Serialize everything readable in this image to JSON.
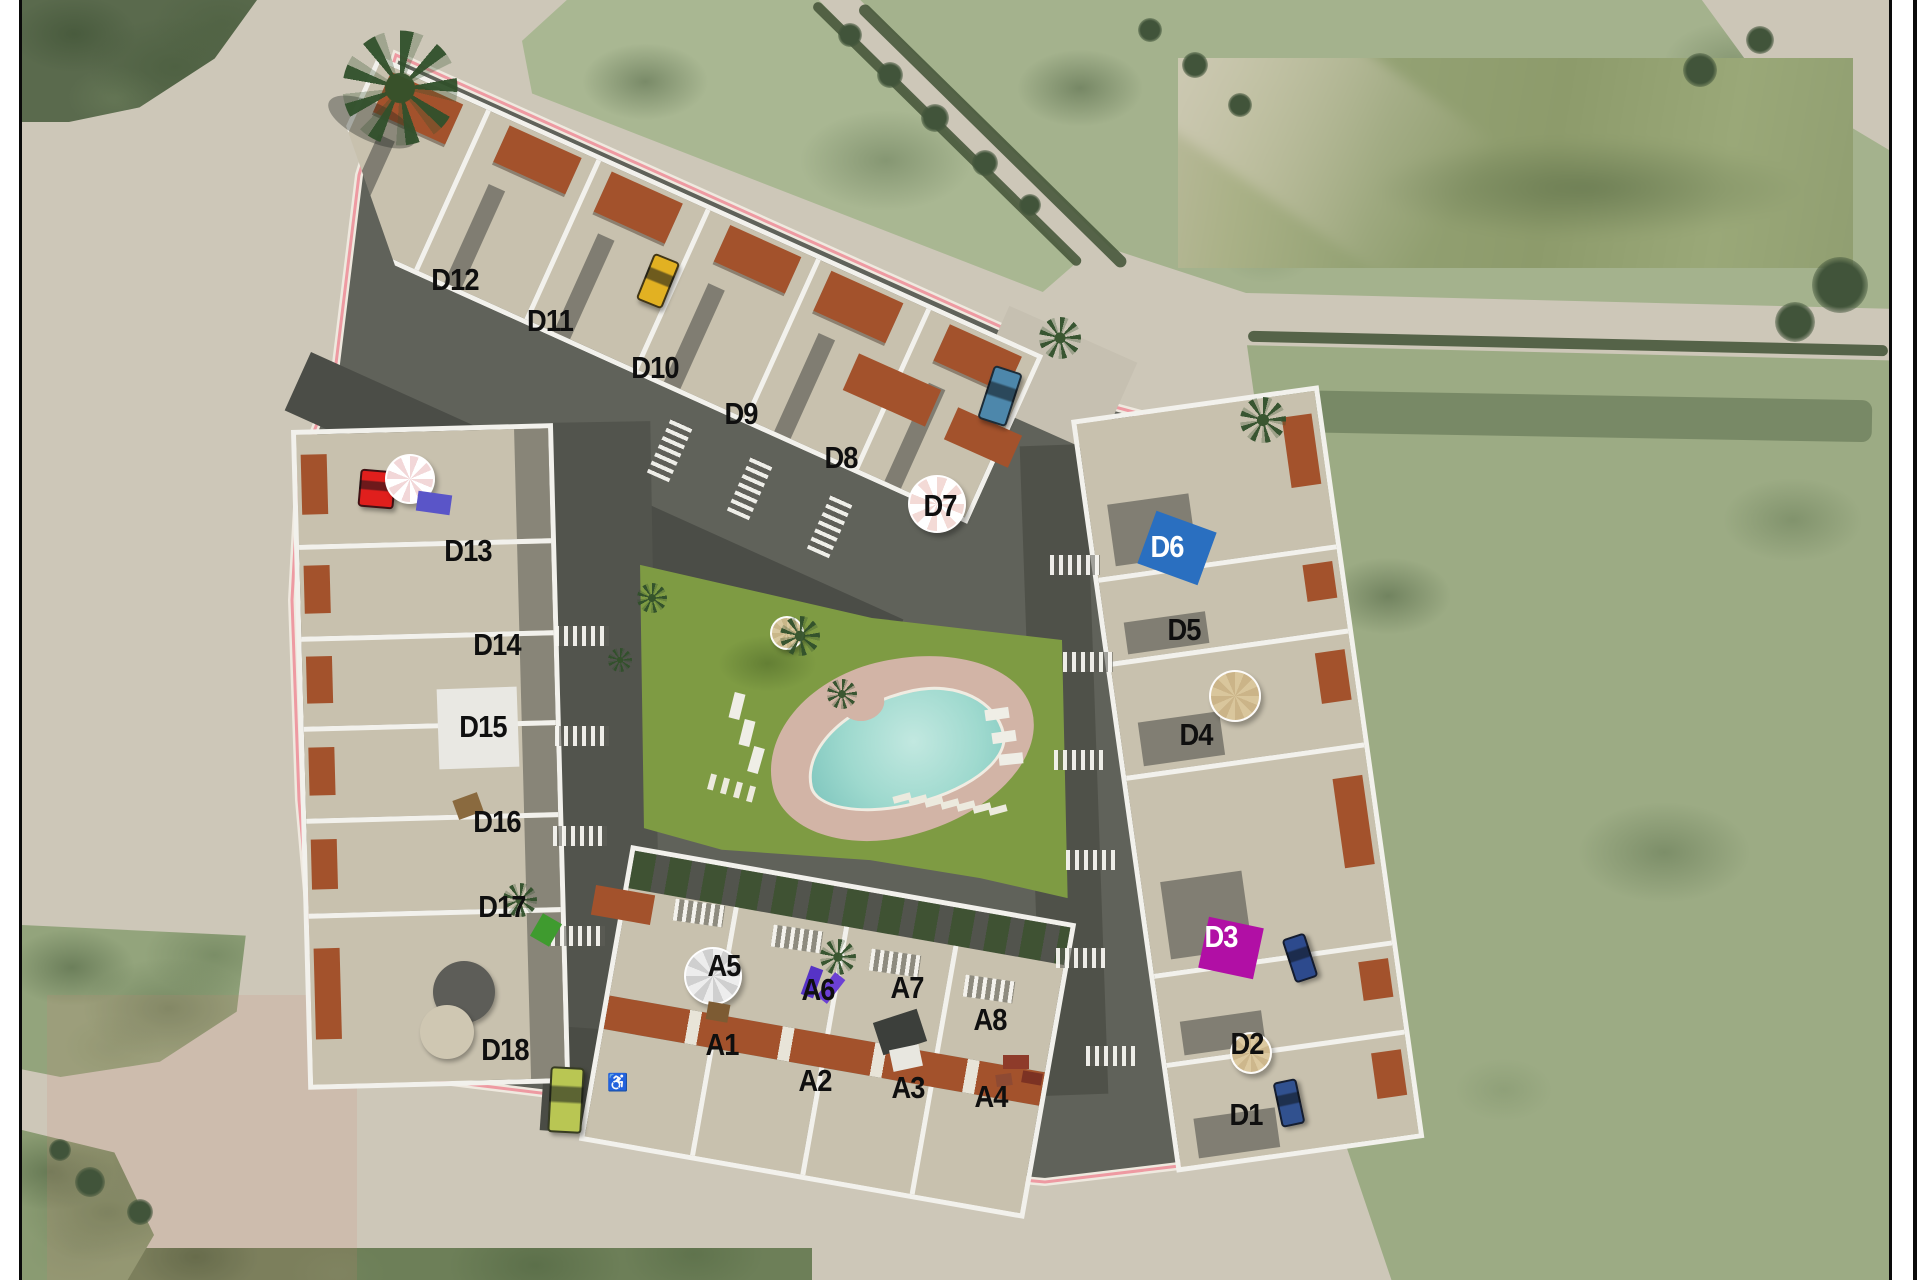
{
  "image_type": "residential development site plan rendered over an aerial photograph",
  "page": {
    "background": "#ffffff",
    "frame_color": "#0a0a0a"
  },
  "colors": {
    "road": "#cdc7b8",
    "field_light": "#a9b792",
    "field_dark": "#5a6a4d",
    "walls": "#f2f1ec",
    "terrace": "#c8c1ae",
    "street_shadow": "#4b4d47",
    "terracotta": "#a3522c",
    "lawn": "#7e9b43",
    "pool_water": "#9ed9ce",
    "pool_deck": "#d2b4a6",
    "boundary_line": "#ee9aa2",
    "d6_marker": "#2a6fc0",
    "d3_marker": "#b10fa5"
  },
  "labels": [
    {
      "id": "D12",
      "x": 455,
      "y": 280
    },
    {
      "id": "D11",
      "x": 550,
      "y": 321
    },
    {
      "id": "D10",
      "x": 655,
      "y": 368
    },
    {
      "id": "D9",
      "x": 741,
      "y": 414
    },
    {
      "id": "D8",
      "x": 841,
      "y": 458
    },
    {
      "id": "D7",
      "x": 940,
      "y": 506
    },
    {
      "id": "D6",
      "x": 1167,
      "y": 547,
      "style": "white"
    },
    {
      "id": "D5",
      "x": 1184,
      "y": 630
    },
    {
      "id": "D4",
      "x": 1196,
      "y": 735
    },
    {
      "id": "D3",
      "x": 1221,
      "y": 937,
      "style": "white"
    },
    {
      "id": "D2",
      "x": 1247,
      "y": 1044
    },
    {
      "id": "D1",
      "x": 1246,
      "y": 1115
    },
    {
      "id": "D13",
      "x": 468,
      "y": 551
    },
    {
      "id": "D14",
      "x": 497,
      "y": 645
    },
    {
      "id": "D15",
      "x": 483,
      "y": 727
    },
    {
      "id": "D16",
      "x": 497,
      "y": 822
    },
    {
      "id": "D17",
      "x": 502,
      "y": 907
    },
    {
      "id": "D18",
      "x": 505,
      "y": 1050
    },
    {
      "id": "A5",
      "x": 724,
      "y": 966
    },
    {
      "id": "A6",
      "x": 818,
      "y": 990
    },
    {
      "id": "A7",
      "x": 907,
      "y": 988
    },
    {
      "id": "A8",
      "x": 990,
      "y": 1020
    },
    {
      "id": "A1",
      "x": 722,
      "y": 1045
    },
    {
      "id": "A2",
      "x": 815,
      "y": 1081
    },
    {
      "id": "A3",
      "x": 908,
      "y": 1088
    },
    {
      "id": "A4",
      "x": 991,
      "y": 1097
    }
  ],
  "features": [
    {
      "name": "pool-marker-d6",
      "kind": "rect",
      "x": 1177,
      "y": 548,
      "w": 64,
      "h": 56,
      "rot": 20,
      "color": "#2a6fc0"
    },
    {
      "name": "pool-marker-d3",
      "kind": "rect",
      "x": 1231,
      "y": 948,
      "w": 56,
      "h": 52,
      "rot": 12,
      "color": "#b10fa5"
    },
    {
      "name": "car-yellow",
      "kind": "car",
      "x": 658,
      "y": 281,
      "w": 24,
      "h": 46,
      "rot": 22,
      "color": "#e2b122"
    },
    {
      "name": "car-blue",
      "kind": "car",
      "x": 1000,
      "y": 396,
      "w": 26,
      "h": 52,
      "rot": 18,
      "color": "#4d87ab"
    },
    {
      "name": "car-red",
      "kind": "car",
      "x": 377,
      "y": 489,
      "w": 32,
      "h": 34,
      "rot": 5,
      "color": "#e01f1d"
    },
    {
      "name": "car-navy-north",
      "kind": "car",
      "x": 1300,
      "y": 958,
      "w": 20,
      "h": 42,
      "rot": -18,
      "color": "#2d4a8d"
    },
    {
      "name": "car-navy-south",
      "kind": "car",
      "x": 1289,
      "y": 1103,
      "w": 20,
      "h": 42,
      "rot": -12,
      "color": "#31518f"
    },
    {
      "name": "van-lime",
      "kind": "car",
      "x": 566,
      "y": 1100,
      "w": 30,
      "h": 62,
      "rot": 3,
      "color": "#b9c653"
    },
    {
      "name": "umbrella-pink-d13",
      "kind": "umbrella",
      "x": 410,
      "y": 479,
      "d": 46,
      "color": "#f2d7d8",
      "stripe": "#ffffff"
    },
    {
      "name": "umbrella-pink-d7",
      "kind": "umbrella",
      "x": 937,
      "y": 504,
      "d": 54,
      "color": "#f3dad6",
      "stripe": "#ffffff"
    },
    {
      "name": "umbrella-white-a5",
      "kind": "umbrella",
      "x": 713,
      "y": 976,
      "d": 54,
      "color": "#ededed",
      "stripe": "#cfcfcf"
    },
    {
      "name": "umbrella-beige-d4",
      "kind": "umbrella",
      "x": 1235,
      "y": 696,
      "d": 48,
      "color": "#d9c69c",
      "stripe": "#cbb488"
    },
    {
      "name": "umbrella-beige-d2",
      "kind": "umbrella",
      "x": 1251,
      "y": 1053,
      "d": 38,
      "color": "#dcc9a0",
      "stripe": "#cdb78c"
    },
    {
      "name": "umbrella-beige-lawn",
      "kind": "umbrella",
      "x": 787,
      "y": 633,
      "d": 30,
      "color": "#d8c89f",
      "stripe": "#c9b789"
    },
    {
      "name": "lounger-blue-d13",
      "kind": "rect",
      "x": 434,
      "y": 503,
      "w": 34,
      "h": 20,
      "rot": 8,
      "color": "#5a55c8"
    },
    {
      "name": "lounger-white-1",
      "kind": "rect",
      "x": 737,
      "y": 706,
      "w": 11,
      "h": 26,
      "rot": 14,
      "color": "#efeee6"
    },
    {
      "name": "lounger-white-2",
      "kind": "rect",
      "x": 747,
      "y": 733,
      "w": 11,
      "h": 26,
      "rot": 14,
      "color": "#efeee6"
    },
    {
      "name": "lounger-white-3",
      "kind": "rect",
      "x": 756,
      "y": 760,
      "w": 11,
      "h": 26,
      "rot": 16,
      "color": "#efeee6"
    },
    {
      "name": "lounger-white-4",
      "kind": "rect",
      "x": 997,
      "y": 714,
      "w": 24,
      "h": 11,
      "rot": -8,
      "color": "#efeee6"
    },
    {
      "name": "lounger-white-5",
      "kind": "rect",
      "x": 1004,
      "y": 737,
      "w": 24,
      "h": 11,
      "rot": -8,
      "color": "#efeee6"
    },
    {
      "name": "lounger-white-6",
      "kind": "rect",
      "x": 1011,
      "y": 759,
      "w": 24,
      "h": 11,
      "rot": -6,
      "color": "#efeee6"
    },
    {
      "name": "lounger-purple-1",
      "kind": "rect",
      "x": 812,
      "y": 982,
      "w": 13,
      "h": 30,
      "rot": 20,
      "color": "#5633c6"
    },
    {
      "name": "lounger-purple-2",
      "kind": "rect",
      "x": 831,
      "y": 988,
      "w": 13,
      "h": 30,
      "rot": 38,
      "color": "#6c40d4"
    },
    {
      "name": "dome-gray-d18",
      "kind": "disc",
      "x": 464,
      "y": 992,
      "d": 62,
      "color": "#5d5d58"
    },
    {
      "name": "table-round-d18",
      "kind": "disc",
      "x": 447,
      "y": 1032,
      "d": 54,
      "color": "#cfc7b2"
    },
    {
      "name": "terrace-tile-d15",
      "kind": "rect",
      "x": 478,
      "y": 728,
      "w": 80,
      "h": 80,
      "rot": -2,
      "color": "#e9e8e3"
    },
    {
      "name": "furniture-brown-d16",
      "kind": "rect",
      "x": 468,
      "y": 806,
      "w": 26,
      "h": 20,
      "rot": -20,
      "color": "#8a6a3f"
    },
    {
      "name": "furniture-brown-a1",
      "kind": "rect",
      "x": 718,
      "y": 1012,
      "w": 22,
      "h": 18,
      "rot": 10,
      "color": "#7d5b33"
    },
    {
      "name": "gazebo-dark-a3",
      "kind": "rect",
      "x": 900,
      "y": 1032,
      "w": 46,
      "h": 34,
      "rot": -18,
      "color": "#3c3f3b"
    },
    {
      "name": "table-white-a3",
      "kind": "rect",
      "x": 906,
      "y": 1058,
      "w": 30,
      "h": 22,
      "rot": -12,
      "color": "#e8e7e0"
    },
    {
      "name": "furniture-red-a4-1",
      "kind": "rect",
      "x": 1016,
      "y": 1062,
      "w": 26,
      "h": 14,
      "rot": 0,
      "color": "#8e3b2a"
    },
    {
      "name": "furniture-red-a4-2",
      "kind": "rect",
      "x": 1032,
      "y": 1078,
      "w": 20,
      "h": 12,
      "rot": 10,
      "color": "#7c3223"
    },
    {
      "name": "furniture-red-a4-3",
      "kind": "rect",
      "x": 1004,
      "y": 1080,
      "w": 16,
      "h": 12,
      "rot": -8,
      "color": "#8e4a33"
    },
    {
      "name": "palm-entry-shadow",
      "kind": "shadow",
      "x": 372,
      "y": 122,
      "w": 95,
      "h": 38,
      "rot": 25,
      "color": "rgba(30,35,28,.35)"
    },
    {
      "name": "palm-entry",
      "kind": "palm",
      "x": 400,
      "y": 88,
      "d": 115
    },
    {
      "name": "palm-northrow",
      "kind": "palm",
      "x": 1060,
      "y": 338,
      "d": 42
    },
    {
      "name": "palm-roundabout",
      "kind": "palm",
      "x": 1263,
      "y": 420,
      "d": 46
    },
    {
      "name": "palm-arow",
      "kind": "palm",
      "x": 838,
      "y": 957,
      "d": 36
    },
    {
      "name": "palm-d17",
      "kind": "palm",
      "x": 520,
      "y": 900,
      "d": 34
    },
    {
      "name": "palm-lawn-1",
      "kind": "palm",
      "x": 800,
      "y": 636,
      "d": 40
    },
    {
      "name": "palm-lawn-2",
      "kind": "palm",
      "x": 842,
      "y": 694,
      "d": 30
    },
    {
      "name": "palm-lawn-3",
      "kind": "palm",
      "x": 652,
      "y": 598,
      "d": 30
    },
    {
      "name": "palm-lawn-4",
      "kind": "palm",
      "x": 620,
      "y": 660,
      "d": 24
    },
    {
      "name": "bush-green-d17",
      "kind": "rect",
      "x": 546,
      "y": 930,
      "w": 22,
      "h": 26,
      "rot": 30,
      "color": "#3f9b2f"
    },
    {
      "name": "tree-road-1",
      "kind": "tree",
      "x": 850,
      "y": 35,
      "d": 24
    },
    {
      "name": "tree-road-2",
      "kind": "tree",
      "x": 890,
      "y": 75,
      "d": 26
    },
    {
      "name": "tree-road-3",
      "kind": "tree",
      "x": 935,
      "y": 118,
      "d": 28
    },
    {
      "name": "tree-road-4",
      "kind": "tree",
      "x": 985,
      "y": 163,
      "d": 26
    },
    {
      "name": "tree-road-5",
      "kind": "tree",
      "x": 1030,
      "y": 205,
      "d": 22
    },
    {
      "name": "tree-road-6",
      "kind": "tree",
      "x": 1150,
      "y": 30,
      "d": 24
    },
    {
      "name": "tree-road-7",
      "kind": "tree",
      "x": 1195,
      "y": 65,
      "d": 26
    },
    {
      "name": "tree-road-8",
      "kind": "tree",
      "x": 1240,
      "y": 105,
      "d": 24
    },
    {
      "name": "tree-corner-tr-1",
      "kind": "tree",
      "x": 1700,
      "y": 70,
      "d": 34
    },
    {
      "name": "tree-corner-tr-2",
      "kind": "tree",
      "x": 1760,
      "y": 40,
      "d": 28
    },
    {
      "name": "tree-right-1",
      "kind": "tree",
      "x": 1840,
      "y": 285,
      "d": 56
    },
    {
      "name": "tree-right-2",
      "kind": "tree",
      "x": 1795,
      "y": 322,
      "d": 40
    },
    {
      "name": "tree-corner-bl-1",
      "kind": "tree",
      "x": 90,
      "y": 1182,
      "d": 30
    },
    {
      "name": "tree-corner-bl-2",
      "kind": "tree",
      "x": 140,
      "y": 1212,
      "d": 26
    },
    {
      "name": "tree-corner-bl-3",
      "kind": "tree",
      "x": 60,
      "y": 1150,
      "d": 22
    },
    {
      "name": "crosswalk-dash-1",
      "kind": "rect",
      "x": 902,
      "y": 798,
      "w": 7,
      "h": 18,
      "rot": 75,
      "color": "#eceade"
    },
    {
      "name": "crosswalk-dash-2",
      "kind": "rect",
      "x": 918,
      "y": 800,
      "w": 7,
      "h": 18,
      "rot": 75,
      "color": "#eceade"
    },
    {
      "name": "crosswalk-dash-3",
      "kind": "rect",
      "x": 934,
      "y": 802,
      "w": 7,
      "h": 18,
      "rot": 75,
      "color": "#eceade"
    },
    {
      "name": "crosswalk-dash-4",
      "kind": "rect",
      "x": 950,
      "y": 804,
      "w": 7,
      "h": 18,
      "rot": 75,
      "color": "#eceade"
    },
    {
      "name": "crosswalk-dash-5",
      "kind": "rect",
      "x": 966,
      "y": 806,
      "w": 7,
      "h": 18,
      "rot": 75,
      "color": "#eceade"
    },
    {
      "name": "crosswalk-dash-6",
      "kind": "rect",
      "x": 982,
      "y": 808,
      "w": 7,
      "h": 18,
      "rot": 75,
      "color": "#eceade"
    },
    {
      "name": "crosswalk-dash-7",
      "kind": "rect",
      "x": 998,
      "y": 810,
      "w": 7,
      "h": 18,
      "rot": 75,
      "color": "#eceade"
    },
    {
      "name": "path-dash-1",
      "kind": "rect",
      "x": 712,
      "y": 782,
      "w": 6,
      "h": 16,
      "rot": 15,
      "color": "#eceade"
    },
    {
      "name": "path-dash-2",
      "kind": "rect",
      "x": 725,
      "y": 786,
      "w": 6,
      "h": 16,
      "rot": 15,
      "color": "#eceade"
    },
    {
      "name": "path-dash-3",
      "kind": "rect",
      "x": 738,
      "y": 790,
      "w": 6,
      "h": 16,
      "rot": 15,
      "color": "#eceade"
    },
    {
      "name": "path-dash-4",
      "kind": "rect",
      "x": 751,
      "y": 794,
      "w": 6,
      "h": 16,
      "rot": 15,
      "color": "#eceade"
    },
    {
      "name": "accessible-parking-icon",
      "kind": "glyph",
      "x": 618,
      "y": 1082,
      "w": 22,
      "h": 22,
      "glyph": "♿",
      "color": "#ffffff"
    }
  ]
}
